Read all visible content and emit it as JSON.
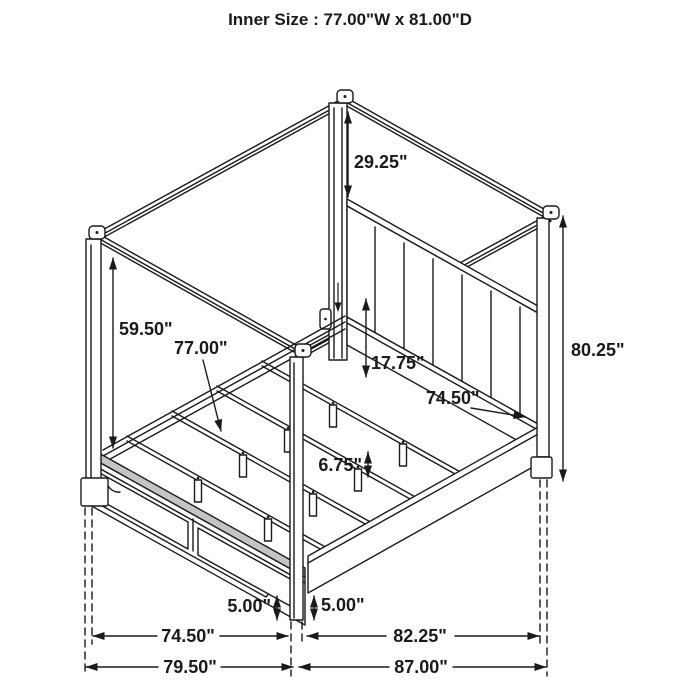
{
  "title": "Inner Size : 77.00\"W x 81.00\"D",
  "diagram": {
    "subject": "four-poster canopy bed with underbed storage drawers, isometric dimension drawing",
    "line_color": "#1a1a1a",
    "background_color": "#ffffff",
    "dimensions": {
      "canopy_to_headboard_height": "29.25\"",
      "footboard_to_canopy_height": "59.50\"",
      "slat_inner_width": "77.00\"",
      "headboard_rail_height": "17.75\"",
      "side_rail_length": "74.50\"",
      "overall_post_height": "80.25\"",
      "slat_leg_height": "6.75\"",
      "floor_clearance_left": "5.00\"",
      "floor_clearance_right": "5.00\"",
      "footboard_width": "74.50\"",
      "side_depth": "82.25\"",
      "overall_width": "79.50\"",
      "overall_depth": "87.00\""
    }
  }
}
